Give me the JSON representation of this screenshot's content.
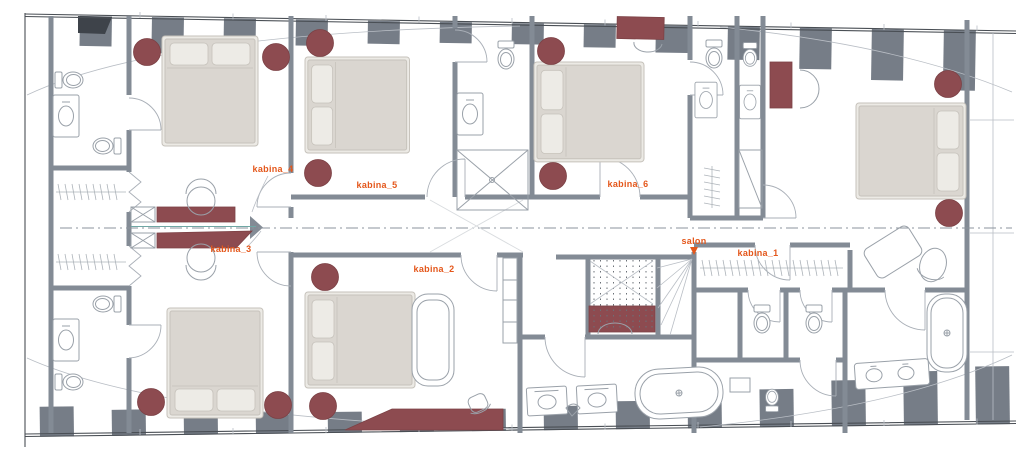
{
  "floor_plan": {
    "cabins": [
      {
        "id": "kabina_1",
        "label": "kabina_1"
      },
      {
        "id": "kabina_2",
        "label": "kabina_2"
      },
      {
        "id": "kabina_3",
        "label": "kabina_3"
      },
      {
        "id": "kabina_4",
        "label": "kabina_4"
      },
      {
        "id": "kabina_5",
        "label": "kabina_5"
      },
      {
        "id": "kabina_6",
        "label": "kabina_6"
      }
    ],
    "salon": {
      "label": "salon"
    },
    "colors": {
      "label_accent": "#e4571b",
      "furniture_maroon": "#8d4b50",
      "wall_gray": "#838b95",
      "stripe_gray": "#767d87",
      "bed_fill": "#dad6d0",
      "bed_edge": "#c6c2bb",
      "fixture_line": "#9aa1a9",
      "centerline": "#8b939c",
      "hull_line": "#4a4f55"
    }
  }
}
